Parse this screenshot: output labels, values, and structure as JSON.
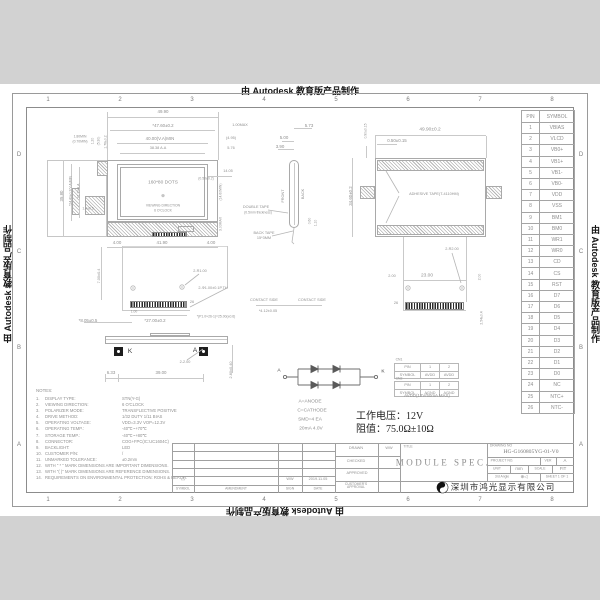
{
  "watermark": {
    "text": "由 Autodesk 教育版产品制作"
  },
  "frame": {
    "cols": [
      "1",
      "2",
      "3",
      "4",
      "5",
      "6",
      "7",
      "8"
    ],
    "rows": [
      "D",
      "C",
      "B",
      "A"
    ]
  },
  "front_view": {
    "display": "160*80 DOTS",
    "center_mark": "⊕",
    "viewing1": "VIEWING DIRECTION",
    "viewing2": "6 O'CLOCK",
    "dims": {
      "ow": "49.90",
      "cw": "*47.60±0.2",
      "vw": "40.00(V.A)MIN",
      "aw": "38.38 A.A",
      "rgap": "1.00MAX",
      "rref": "(4.95)",
      "redge": "5.76",
      "rh": "14.05",
      "rvamin": "(14.60MIN)",
      "rbezel": "3.00MAX",
      "rtol": "(0.50±0.2)",
      "oh": "35.80",
      "vh": "*24.40±0.2(V.A)MIN",
      "ah": "21.10 A.A",
      "t1": "1.20",
      "t2": "(5.30)",
      "t3": "1.76±0.2",
      "lens1": "1.80MIN",
      "lens2": "(0.70MIN)",
      "led": "1.4±0.5",
      "b1": "4.00",
      "b2": "41.90",
      "b3": "4.00"
    },
    "labels": {
      "dt1": "DOUBLE TAPE",
      "dt2": "(0.5mm thickness)",
      "bt1": "BACK TAPE",
      "bt2": "15*3MM"
    }
  },
  "side_view": {
    "front": "FRONT",
    "back": "BACK",
    "dims": {
      "a": "5.73",
      "b": "5.00",
      "c": "3.90",
      "d": "0.60",
      "e": "1.10"
    }
  },
  "back_view": {
    "adhesive": "ADHESIVE TAPE(T-4110HM)",
    "dims": {
      "w": "49.90±0.2",
      "t1": "0.50±0.15",
      "t2": "0.90±0.15",
      "h": "34.60±0.2",
      "holes": "2-R2.00",
      "e1": "2.00",
      "span": "23.00",
      "e2": "2.00",
      "tail": "2.54±0.4",
      "pins": "26"
    }
  },
  "fpc_view": {
    "slot": "2-R1.00",
    "hole": "2-Φ1.00±0.1P.TH",
    "pins": "26",
    "contact1": "CONTACT SIDE",
    "contact2": "CONTACT SIDE",
    "dims": {
      "h": "7.00±0.4",
      "first": "1.00",
      "w": "*27.00±0.2",
      "pitch": "*(P1.0×26-1)=25.00(±0.6)",
      "offset": "*8.05±0.5",
      "cw": "*4.12±0.05"
    }
  },
  "bottom_view": {
    "k": "K",
    "a": "A",
    "dims": {
      "pads": "2-2.00",
      "left": "6.33",
      "span": "39.00",
      "h": "2.80±0.40"
    }
  },
  "led_circuit": {
    "a": "A",
    "k": "K",
    "n1": "A=ANODE",
    "n2": "C=CATHODE",
    "n3": "SMD=4 EA",
    "n4": "20mA 4.0V"
  },
  "connector_tables": {
    "cn1_title": "CN1",
    "cn2_title": "CN2",
    "cn1": {
      "r1": [
        "PIN",
        "1",
        "2"
      ],
      "r2": [
        "SYMBOL",
        "AVDD",
        "AVDD"
      ]
    },
    "cn2": {
      "r1": [
        "PIN",
        "1",
        "2"
      ],
      "r2": [
        "SYMBOL",
        "AGND",
        "AGND"
      ]
    },
    "note": "AVDD(12V/50mA MAX)"
  },
  "spec_cn": {
    "voltage": "工作电压：12V",
    "resistance": "阻值：75.0Ω±10Ω"
  },
  "pin_table": {
    "headers": [
      "PIN",
      "SYMBOL"
    ],
    "rows": [
      [
        "1",
        "VBIAS"
      ],
      [
        "2",
        "VLCD"
      ],
      [
        "3",
        "VB0+"
      ],
      [
        "4",
        "VB1+"
      ],
      [
        "5",
        "VB1-"
      ],
      [
        "6",
        "VB0-"
      ],
      [
        "7",
        "VDD"
      ],
      [
        "8",
        "VSS"
      ],
      [
        "9",
        "BM1"
      ],
      [
        "10",
        "BM0"
      ],
      [
        "11",
        "WR1"
      ],
      [
        "12",
        "WR0"
      ],
      [
        "13",
        "CD"
      ],
      [
        "14",
        "CS"
      ],
      [
        "15",
        "RST"
      ],
      [
        "16",
        "D7"
      ],
      [
        "17",
        "D6"
      ],
      [
        "18",
        "D5"
      ],
      [
        "19",
        "D4"
      ],
      [
        "20",
        "D3"
      ],
      [
        "21",
        "D2"
      ],
      [
        "22",
        "D1"
      ],
      [
        "23",
        "D0"
      ],
      [
        "24",
        "NC"
      ],
      [
        "25",
        "NTC+"
      ],
      [
        "26",
        "NTC-"
      ]
    ]
  },
  "notes": {
    "title": "NOTES:",
    "items": [
      {
        "no": "1.",
        "label": "DISPLAY TYPE:",
        "value": "STN(Y-G)"
      },
      {
        "no": "2.",
        "label": "VIEWING DIRECTION:",
        "value": "6 O'CLOCK"
      },
      {
        "no": "3.",
        "label": "POLARIZER MODE:",
        "value": "TRANSFLECTIVE POSITIVE"
      },
      {
        "no": "4.",
        "label": "DRIVE METHOD:",
        "value": "1/32 DUTY 1/11 BIAS"
      },
      {
        "no": "5.",
        "label": "OPERATING VOLTAGE:",
        "value": "VDD=3.3V  VOP=12.3V"
      },
      {
        "no": "6.",
        "label": "OPERATING TEMP.:",
        "value": "-40℃~+70℃"
      },
      {
        "no": "7.",
        "label": "STORAGE TEMP.:",
        "value": "-40℃~+80℃"
      },
      {
        "no": "8.",
        "label": "CONNECTOR:",
        "value": "COG+FPC(IC:UC1604C)"
      },
      {
        "no": "9.",
        "label": "BACKLIGHT:",
        "value": "LED"
      },
      {
        "no": "10.",
        "label": "CUSTOMER P/N:",
        "value": "/"
      },
      {
        "no": "11.",
        "label": "UNMARKED TOLERANCE:",
        "value": "±0.2mm"
      },
      {
        "no": "12.",
        "label": "WITH \" * \" MARK DIMENSIONS ARE IMPORTANT DIMENSIONS.",
        "value": ""
      },
      {
        "no": "13.",
        "label": "WITH \"( )\" MARK DIMENSIONS ARE REFERENCE DIMENSIONS.",
        "value": ""
      },
      {
        "no": "14.",
        "label": "REQUIREMENTS ON ENVIRONMENTAL PROTECTION: ROHS & REACH.",
        "value": ""
      }
    ]
  },
  "title_block": {
    "rev_headers": {
      "symbol": "SYMBOL",
      "amendment": "AMENDMENT",
      "sign": "SIGN",
      "date": "DATE"
    },
    "rev_row": {
      "symbol": "△",
      "amendment": "",
      "sign": "WW",
      "date": "2019.11.05"
    },
    "staff": {
      "drawn_label": "DRAWN",
      "drawn": "WW",
      "checked_label": "CHECKED",
      "checked": "",
      "approved_label": "APPROVED",
      "approved": "",
      "customer_label": "CUSTOMER'S APPROVAL",
      "customer": ""
    },
    "title_label": "TITLE",
    "title": "MODULE  SPEC.",
    "drawing_no_label": "DRAWING NO",
    "drawing_no": "HG-G160805YG-01-V0",
    "project_label": "PROJECT NO.",
    "ver_label": "VER",
    "ver": "A",
    "unit_label": "UNIT",
    "unit": "mm",
    "scale_label": "SCALE",
    "scale": "FIT",
    "angle_label": "3rd Angle",
    "projection": "⊕◁",
    "sheet": "SHEET 1 OF 1",
    "company": "深圳市鸿光显示有限公司"
  }
}
